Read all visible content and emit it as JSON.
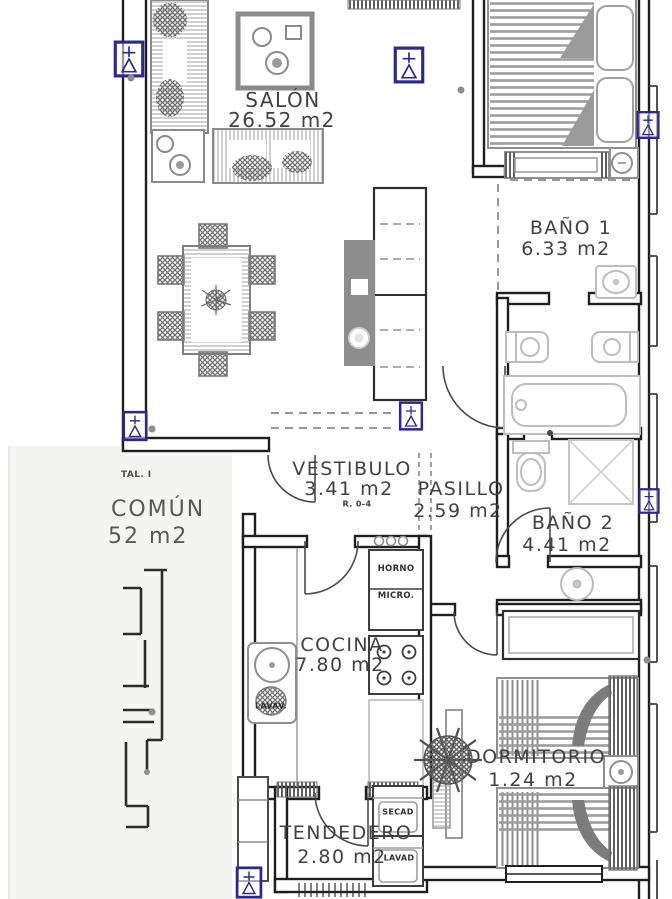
{
  "rooms": {
    "salon": {
      "name": "SALÓN",
      "area": "26.52 m2"
    },
    "bano1": {
      "name": "BAÑO 1",
      "area": "6.33 m2"
    },
    "vestibulo": {
      "name": "VESTIBULO",
      "area": "3.41 m2",
      "note": "R. 0-4"
    },
    "pasillo": {
      "name": "PASILLO",
      "area": "2.59 m2"
    },
    "bano2": {
      "name": "BAÑO 2",
      "area": "4.41 m2"
    },
    "cocina": {
      "name": "COCINA",
      "area": "7.80 m2"
    },
    "dormitorio": {
      "name": "DORMITORIO",
      "area": "1.24 m2"
    },
    "tendedero": {
      "name": "TENDEDERO",
      "area": "2.80 m2"
    },
    "comun": {
      "label_partial": "COMÚN",
      "area_partial": "52 m2",
      "note_partial": "TAL. I"
    }
  },
  "appliances": {
    "horno": "HORNO",
    "micro": "MICRO.",
    "lavav": "LAVAV.",
    "secad": "SECAD",
    "lavad": "LAVAD"
  },
  "colors": {
    "walls": "#1f1f1f",
    "furniture_gray": "#8f8f8f",
    "fixture_gray": "#bdbdbd",
    "window_marker_blue": "#2a2a8c",
    "label_text": "#414141",
    "side_panel": "#f4f4f1"
  }
}
